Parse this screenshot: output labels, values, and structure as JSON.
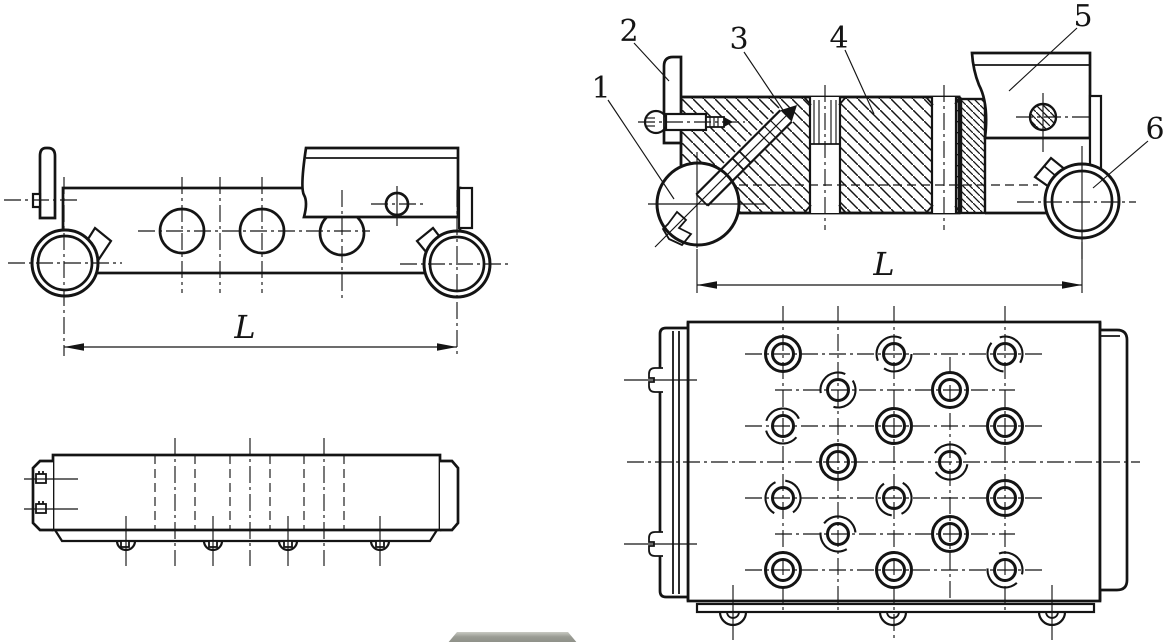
{
  "figure": {
    "type": "engineering-assembly-drawing",
    "background": "#ffffff",
    "line_color": "#141414",
    "part_labels": {
      "p1": "1",
      "p2": "2",
      "p3": "3",
      "p4": "4",
      "p5": "5",
      "p6": "6"
    },
    "dimensions": {
      "side_view_length": "L",
      "section_view_length": "L"
    }
  },
  "bottom_widget": {
    "color": "#8b8d85"
  }
}
